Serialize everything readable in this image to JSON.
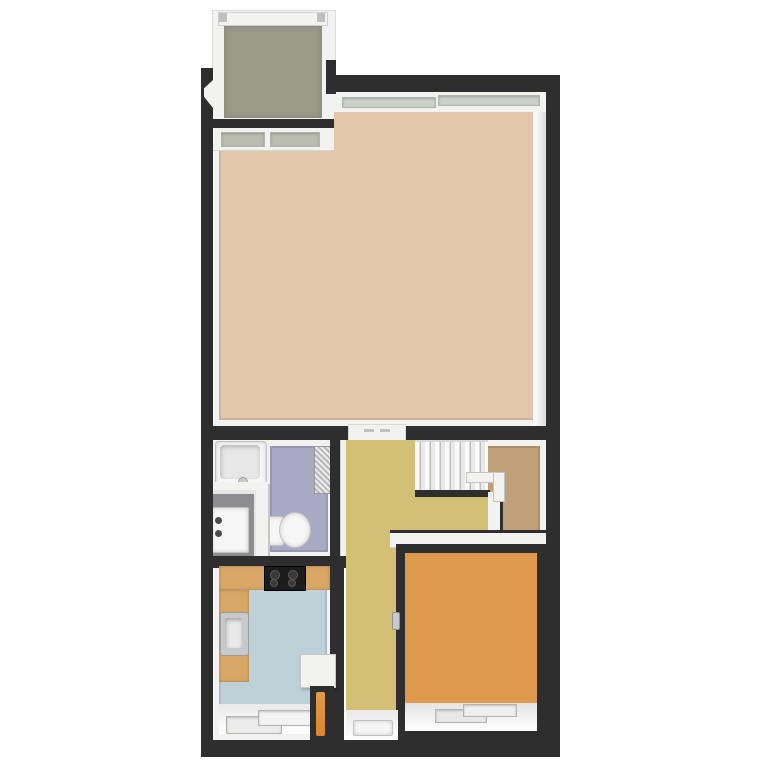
{
  "scene": {
    "type": "3d-floor-plan-render",
    "background_color": "#ffffff",
    "exterior_wall_color": "#2e2e2e",
    "interior_wall_face_color": "#f2f2f0"
  },
  "css_vars": {
    "bg": "#ffffff",
    "wall": "#2e2e2e",
    "wallface": "#f2f2f0",
    "wallshade": "#d9d9d9",
    "living": "#e4c7ab",
    "balcony": "#9a9b88",
    "bathroom": "#a9a9c4",
    "utility": "#8d8d90",
    "hall": "#d3c075",
    "landing": "#bfa078",
    "bedroom": "#dd9a4c",
    "kitchen": "#bed1d8",
    "wood": "#d9a765",
    "cooktop": "#1c1c1c",
    "steel": "#c8c9ca",
    "fixture": "#f6f6f6",
    "glass": "#ccd0c9",
    "glassolive": "#b9bcae",
    "boiler": "#d9862f"
  },
  "rooms": [
    {
      "id": "balcony",
      "floor_color": "#9a9b88"
    },
    {
      "id": "living-room",
      "floor_color": "#e4c7ab"
    },
    {
      "id": "bathroom",
      "floor_color": "#a9a9c4"
    },
    {
      "id": "utility-closet",
      "floor_color": "#8d8d90"
    },
    {
      "id": "hallway",
      "floor_color": "#d3c075"
    },
    {
      "id": "stair-landing",
      "floor_color": "#bfa078"
    },
    {
      "id": "kitchen",
      "floor_color": "#bed1d8"
    },
    {
      "id": "bedroom",
      "floor_color": "#dd9a4c"
    }
  ],
  "fixtures": [
    {
      "id": "bathtub",
      "room": "bathroom",
      "color": "#f6f6f6"
    },
    {
      "id": "toilet",
      "room": "bathroom",
      "color": "#f6f6f6"
    },
    {
      "id": "radiator",
      "room": "bathroom",
      "color": "#cccccc"
    },
    {
      "id": "washing-machine",
      "room": "utility-closet",
      "color": "#f6f6f6"
    },
    {
      "id": "staircase",
      "room": "stair-landing",
      "steps": 7,
      "color": "#eeeeee"
    },
    {
      "id": "stair-railing",
      "room": "stair-landing",
      "color": "#f2f2f0"
    },
    {
      "id": "kitchen-counter",
      "room": "kitchen",
      "color": "#d9a765"
    },
    {
      "id": "cooktop",
      "room": "kitchen",
      "burners": 4,
      "color": "#1c1c1c"
    },
    {
      "id": "kitchen-sink",
      "room": "kitchen",
      "color": "#c8c9ca"
    },
    {
      "id": "side-table",
      "room": "hallway",
      "color": "#f2f2f0"
    },
    {
      "id": "boiler-duct",
      "room": "hallway",
      "color": "#d9862f"
    },
    {
      "id": "entry-door",
      "room": "hallway",
      "color": "#f6f6f6"
    },
    {
      "id": "bedroom-door-handle",
      "room": "bedroom",
      "color": "#c8c9ca"
    },
    {
      "id": "balcony-railing",
      "room": "balcony",
      "color": "#f2f2f0"
    }
  ],
  "windows": [
    {
      "id": "living-room-top-window",
      "panes": 2
    },
    {
      "id": "balcony-door-window",
      "panes": 2
    },
    {
      "id": "kitchen-window",
      "panes": 2
    },
    {
      "id": "bedroom-window",
      "panes": 2
    }
  ]
}
